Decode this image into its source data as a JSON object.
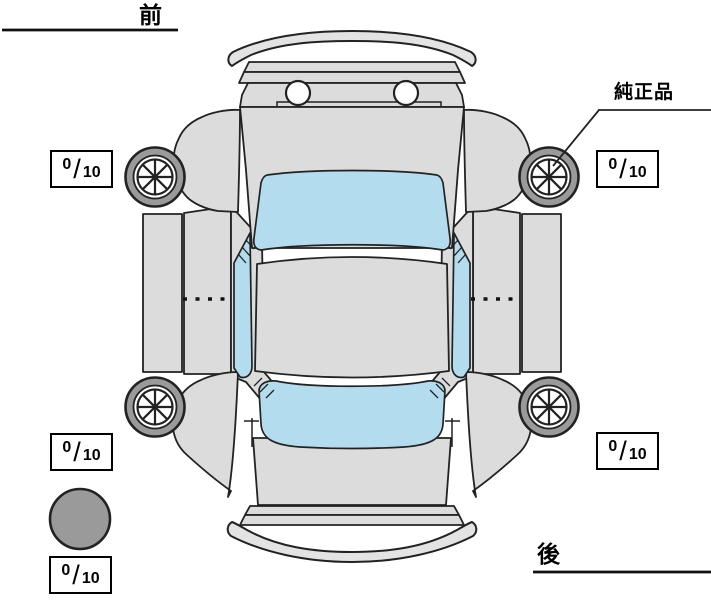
{
  "diagram": {
    "labels": {
      "front": "前",
      "rear": "後",
      "genuine_part": "純正品"
    },
    "tire_scores": {
      "front_left": {
        "value": "0",
        "slash": "/",
        "max": "10"
      },
      "front_right": {
        "value": "0",
        "slash": "/",
        "max": "10"
      },
      "rear_left": {
        "value": "0",
        "slash": "/",
        "max": "10"
      },
      "rear_right": {
        "value": "0",
        "slash": "/",
        "max": "10"
      },
      "spare": {
        "value": "0",
        "slash": "/",
        "max": "10"
      }
    },
    "colors": {
      "body": "#dcdcdc",
      "bumper": "#e3e3e3",
      "glass": "#b3dcef",
      "tire": "#9a9a9a",
      "outline": "#222222"
    },
    "icons": {
      "wheel": "wheel-icon",
      "spare": "spare-tire-icon"
    }
  }
}
